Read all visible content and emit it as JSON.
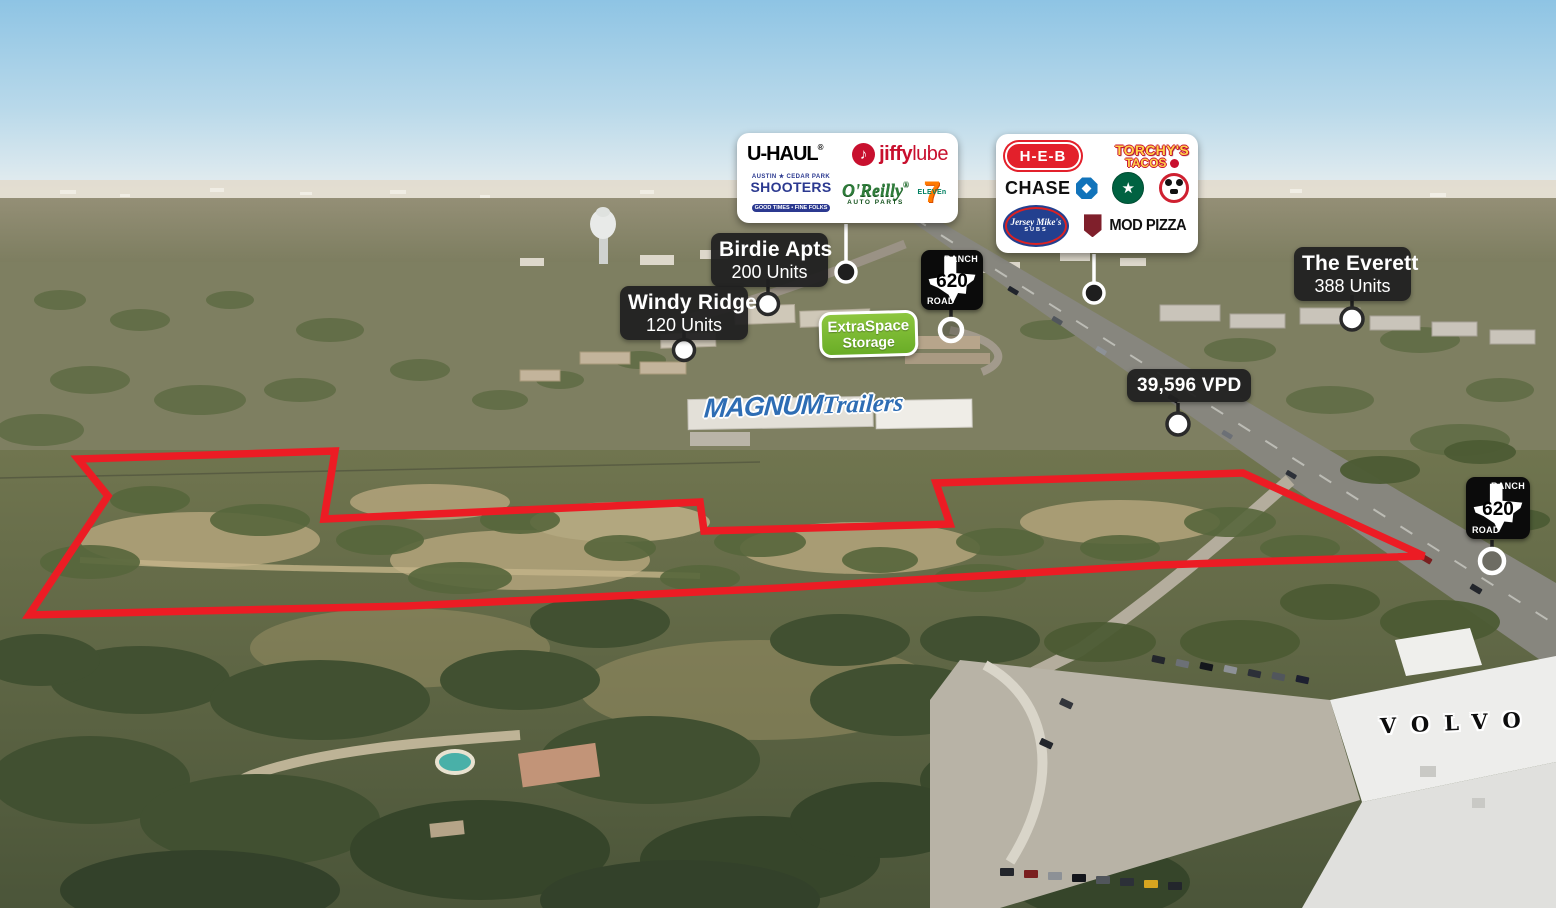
{
  "scene": {
    "description": "Aerial property marketing photo with tenant logos, apartment unit counts, traffic count and red boundary outline",
    "boundary_color": "#ec1c24",
    "badge_bg": "#212121"
  },
  "badges": {
    "birdie": {
      "name": "Birdie Apts",
      "units": "200 Units"
    },
    "windy": {
      "name": "Windy Ridge",
      "units": "120 Units"
    },
    "everett": {
      "name": "The Everett",
      "units": "388 Units"
    },
    "traffic": {
      "label": "39,596 VPD"
    }
  },
  "road_sign": {
    "ranch": "RANCH",
    "number": "620",
    "road": "ROAD"
  },
  "site_labels": {
    "extraspace": {
      "line1": "ExtraSpace",
      "line2": "Storage",
      "color": "#7db92d"
    },
    "magnum": {
      "word1": "MAGNUM",
      "word2": "Trailers",
      "color": "#2e6db4"
    },
    "volvo": {
      "text": "VOLVO"
    }
  },
  "logo_panel_left": {
    "uhaul": {
      "text": "U-HAUL",
      "reg": "®",
      "bar_color": "#f47b20"
    },
    "jiffy": {
      "icon": "♪",
      "word1": "jiffy",
      "word2": "lube",
      "color": "#c8102e"
    },
    "shooters": {
      "top": "AUSTIN ★ CEDAR PARK",
      "name": "SHOOTERS",
      "bottom": "GOOD TIMES • FINE FOLKS",
      "color": "#2b3990"
    },
    "oreilly": {
      "name": "O'Reilly",
      "sub": "AUTO PARTS",
      "color": "#2f7d3b"
    },
    "seven_eleven": {
      "seven": "7",
      "eleven": "ELEVEn",
      "seven_color": "#ff7a00",
      "eleven_color": "#008061"
    }
  },
  "logo_panel_right": {
    "heb": {
      "text": "H-E-B",
      "color": "#e3202b"
    },
    "torchys": {
      "line1": "TORCHY'S",
      "line2": "TACOS",
      "color": "#ffd24a"
    },
    "chase": {
      "text": "CHASE",
      "octagon_color": "#1173ba"
    },
    "starbucks": {
      "icon": "★",
      "color": "#006241"
    },
    "panda": {
      "color": "#cf2030"
    },
    "jersey": {
      "line1": "Jersey Mike's",
      "line2": "SUBS",
      "color": "#23408f"
    },
    "mod": {
      "text": "MOD PIZZA",
      "shield_color": "#7f1f2b"
    }
  }
}
